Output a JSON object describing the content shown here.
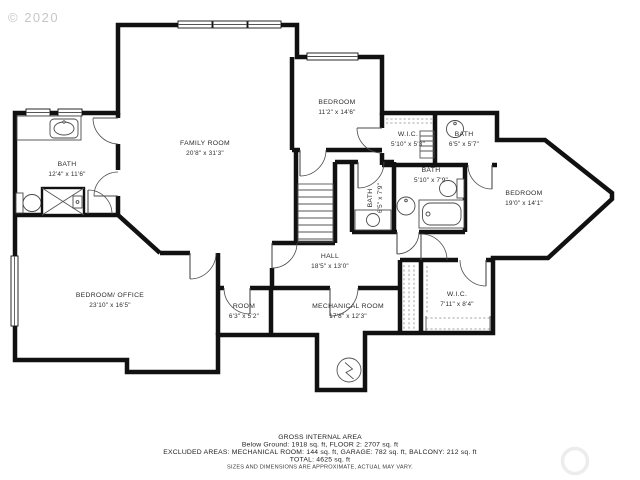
{
  "watermark": "© 2020",
  "rooms": [
    {
      "name": "BATH",
      "dims": "12'4\" x 11'6\""
    },
    {
      "name": "FAMILY ROOM",
      "dims": "20'8\" x 31'3\""
    },
    {
      "name": "BEDROOM",
      "dims": "11'2\" x 14'6\""
    },
    {
      "name": "W.I.C.",
      "dims": "5'10\" x 5'3\""
    },
    {
      "name": "BATH",
      "dims": "6'5\" x 5'7\""
    },
    {
      "name": "BATH",
      "dims": "6'5\" x 7'9\""
    },
    {
      "name": "BATH",
      "dims": "5'10\" x 7'9\""
    },
    {
      "name": "BEDROOM",
      "dims": "19'0\" x 14'1\""
    },
    {
      "name": "HALL",
      "dims": "18'5\" x 13'0\""
    },
    {
      "name": "BEDROOM/ OFFICE",
      "dims": "23'10\" x 16'5\""
    },
    {
      "name": "ROOM",
      "dims": "6'3\" x 5'2\""
    },
    {
      "name": "MECHANICAL ROOM",
      "dims": "17'8\" x 12'3\""
    },
    {
      "name": "W.I.C.",
      "dims": "7'11\" x 8'4\""
    }
  ],
  "footer": {
    "title": "GROSS INTERNAL AREA",
    "line1": "Below Ground: 1918 sq. ft, FLOOR 2: 2707 sq. ft",
    "line2": "EXCLUDED AREAS: MECHANICAL ROOM: 144 sq. ft, GARAGE: 782 sq. ft, BALCONY: 212 sq. ft",
    "line3": "TOTAL: 4625 sq. ft",
    "disclaimer": "SIZES AND DIMENSIONS ARE APPROXIMATE, ACTUAL MAY VARY."
  },
  "icons": {
    "water_heater": "circle-zigzag",
    "shower": "square-x",
    "logo": "faint-ring"
  },
  "colors": {
    "wall": "#111111",
    "label": "#2d2d2d",
    "watermark": "#c7c7c7",
    "background": "#ffffff"
  }
}
